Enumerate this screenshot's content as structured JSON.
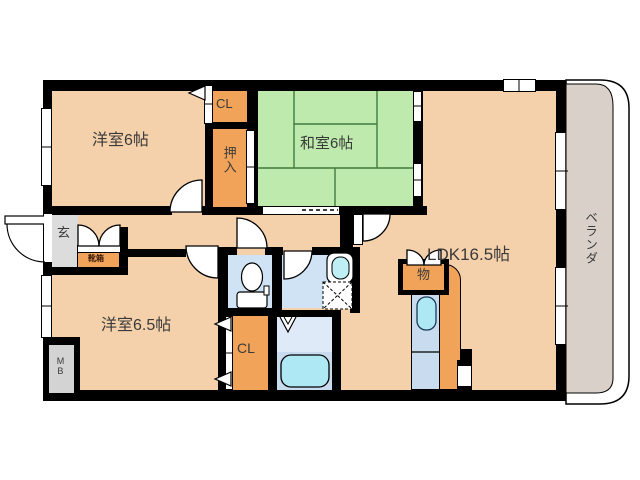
{
  "rooms": {
    "western6": "洋室6帖",
    "japanese6": "和室6帖",
    "ldk": "LDK16.5帖",
    "western65": "洋室6.5帖",
    "veranda": "ベランダ",
    "entrance": "玄"
  },
  "storage": {
    "closet_top": "CL",
    "oshiire": "押入",
    "closet_bottom": "CL",
    "small_storage": "物",
    "shoe_cabinet": "靴箱",
    "meter_box": "MB"
  },
  "colors": {
    "wall": "#000000",
    "room_floor": "#F4D1AB",
    "tatami": "#BEEBAD",
    "tatami_line": "#3F7A3F",
    "closet": "#F0A359",
    "wet_floor": "#CFE3F4",
    "bath_upper": "#DFEAF8",
    "bath_lower": "#C9DCEF",
    "fixture_blue": "#AEE8F4",
    "basin_blue": "#BFEFF5",
    "veranda_floor": "#D9D1C9",
    "entrance_floor": "#DCDCDC",
    "meter_box_floor": "#D3D3D3",
    "text": "#3A3A3A"
  }
}
